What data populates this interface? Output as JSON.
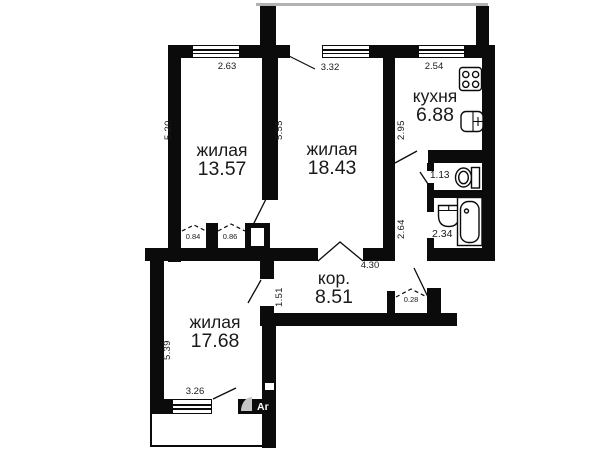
{
  "title": "Floor plan",
  "colors": {
    "wall": "#0b0b0b",
    "balcony-line": "#b2b2b2",
    "watermark": "#c6c6c6",
    "ink": "#1a1a1a"
  },
  "rooms": {
    "room1": {
      "name": "жилая",
      "area": "13.57"
    },
    "room2": {
      "name": "жилая",
      "area": "18.43"
    },
    "kitchen": {
      "name": "кухня",
      "area": "6.88"
    },
    "corridor": {
      "name": "кор.",
      "area": "8.51"
    },
    "room3": {
      "name": "жилая",
      "area": "17.68"
    },
    "wc": {
      "area": "1.13"
    },
    "bathroom": {
      "area": "2.34"
    },
    "closet_left": {
      "area": "0.84"
    },
    "closet_right": {
      "area": "0.86"
    },
    "closet_hall": {
      "area": "0.28"
    }
  },
  "dimensions": {
    "room1_width": "2.63",
    "room2_width": "3.32",
    "kitchen_width": "2.54",
    "room1_depth": "5.20",
    "room2_depth": "5.55",
    "kitchen_depth": "2.95",
    "hall_depth": "2.64",
    "corridor_width": "4.30",
    "corridor_depth": "1.51",
    "room3_depth": "5.39",
    "room3_width": "3.26"
  },
  "icons": {
    "stove": "stove-icon",
    "kitchen_sink": "kitchen-sink-icon",
    "toilet": "toilet-icon",
    "wash_basin": "wash-basin-icon",
    "bathtub": "bathtub-icon"
  },
  "watermark": {
    "text": "Аг"
  }
}
